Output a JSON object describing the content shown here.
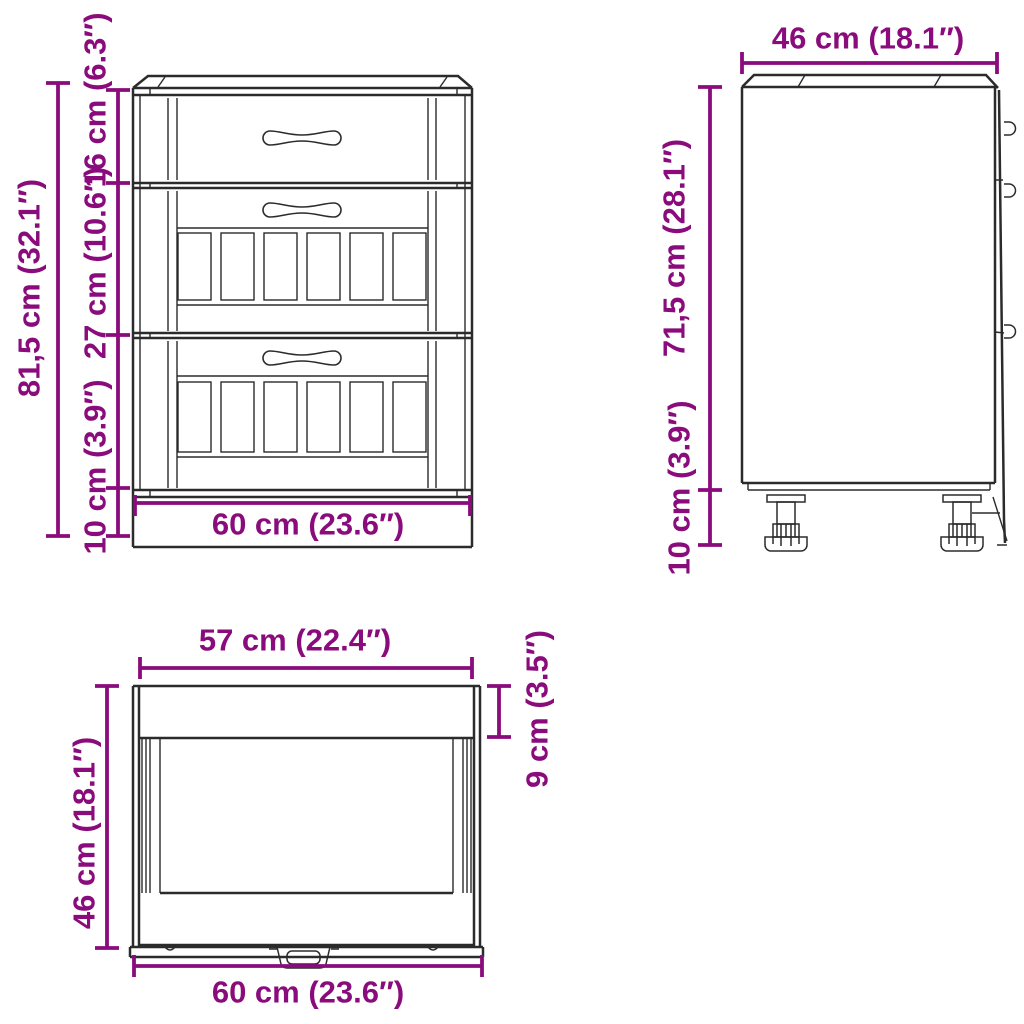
{
  "colors": {
    "dimension_accent": "#8a0c7c",
    "drawing_line": "#2b2b2b",
    "background": "#ffffff"
  },
  "views": {
    "front": {
      "dimensions": {
        "overall_height": "81,5 cm (32.1″)",
        "top_drawer_height": "16 cm (6.3″)",
        "middle_drawer_height": "27 cm (10.6″)",
        "base_height": "10 cm (3.9″)",
        "width": "60 cm (23.6″)"
      }
    },
    "side": {
      "dimensions": {
        "depth": "46 cm (18.1″)",
        "body_height": "71,5 cm (28.1″)",
        "leg_height": "10 cm (3.9″)"
      }
    },
    "top": {
      "dimensions": {
        "worktop_inner_width": "57 cm (22.4″)",
        "depth": "46 cm (18.1″)",
        "worktop_front_depth": "9 cm (3.5″)",
        "width": "60 cm (23.6″)"
      }
    }
  }
}
